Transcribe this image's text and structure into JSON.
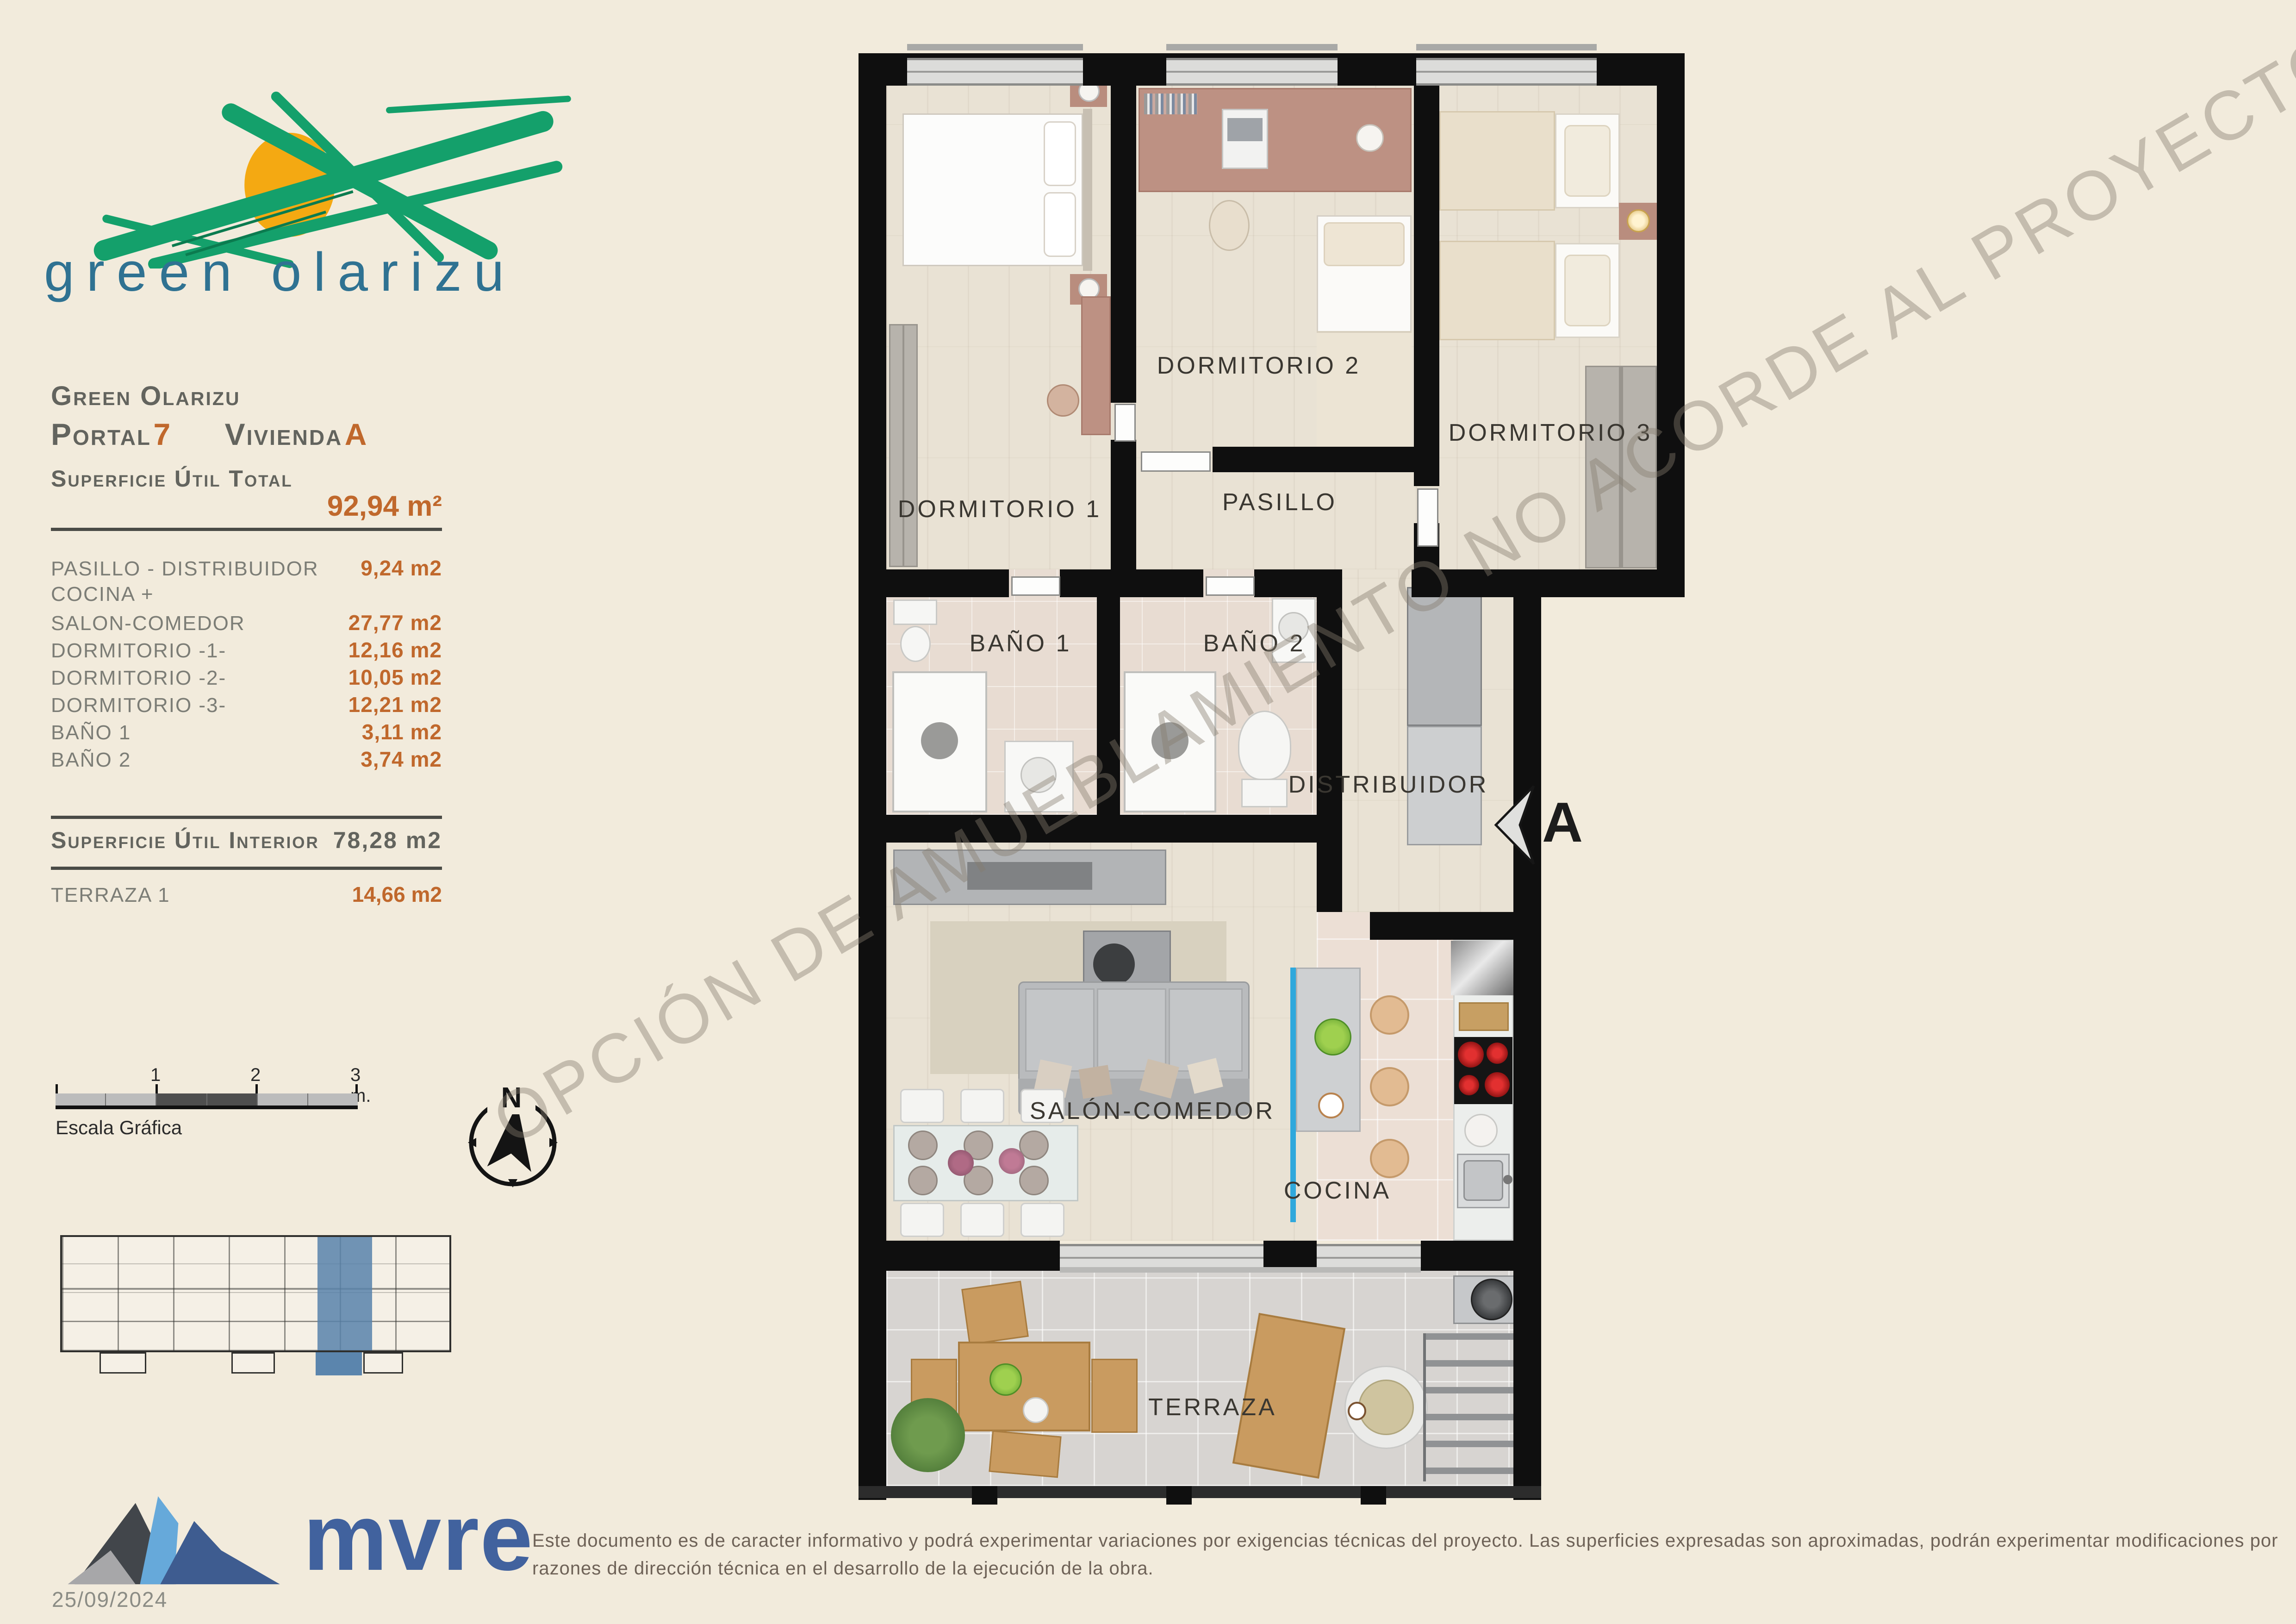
{
  "logo": {
    "name": "green olarizu"
  },
  "info_panel": {
    "project": "Green Olarizu",
    "portal_label": "Portal",
    "portal_number": "7",
    "vivienda_label": "Vivienda",
    "vivienda_letter": "A",
    "total_label": "Superficie Útil Total",
    "total_value": "92,94 m²",
    "rooms": [
      {
        "label": "PASILLO - DISTRIBUIDOR",
        "value": "9,24 m2"
      },
      {
        "label": "COCINA +",
        "value": ""
      },
      {
        "label": "SALON-COMEDOR",
        "value": "27,77 m2"
      },
      {
        "label": "DORMITORIO -1-",
        "value": "12,16 m2"
      },
      {
        "label": "DORMITORIO -2-",
        "value": "10,05 m2"
      },
      {
        "label": "DORMITORIO -3-",
        "value": "12,21 m2"
      },
      {
        "label": "BAÑO 1",
        "value": "3,11 m2"
      },
      {
        "label": "BAÑO 2",
        "value": "3,74 m2"
      }
    ],
    "interior_label": "Superficie Útil Interior",
    "interior_value": "78,28 m2",
    "terraza_label": "TERRAZA 1",
    "terraza_value": "14,66 m2"
  },
  "scale_bar": {
    "tick1": "1",
    "tick2": "2",
    "tick3": "3 m.",
    "caption": "Escala Gráfica"
  },
  "compass": {
    "letter": "N"
  },
  "floor_plan": {
    "labels": {
      "dormitorio1": "DORMITORIO 1",
      "dormitorio2": "DORMITORIO 2",
      "dormitorio3": "DORMITORIO 3",
      "pasillo": "PASILLO",
      "bano1": "BAÑO 1",
      "bano2": "BAÑO 2",
      "distribuidor": "DISTRIBUIDOR",
      "salon": "SALÓN-COMEDOR",
      "cocina": "COCINA",
      "terraza": "TERRAZA"
    },
    "section_marker": "A",
    "watermark": "OPCIÓN DE AMUEBLAMIENTO NO ACORDE AL PROYECTO APROBADO"
  },
  "footer": {
    "brand": "mvre",
    "date": "25/09/2024",
    "disclaimer": "Este documento es de caracter informativo y podrá experimentar variaciones por exigencias técnicas del proyecto. Las superficies expresadas son aproximadas, podrán experimentar modificaciones por razones de dirección técnica en el desarrollo de la ejecución de la obra."
  },
  "colors": {
    "accent_orange": "#c0682c",
    "brand_green": "#14a06b",
    "brand_sun": "#f4a912",
    "brand_blue_text": "#2f7292",
    "highlight_unit_blue": "#5b85ad",
    "island_edge_blue": "#2fa8dc"
  }
}
